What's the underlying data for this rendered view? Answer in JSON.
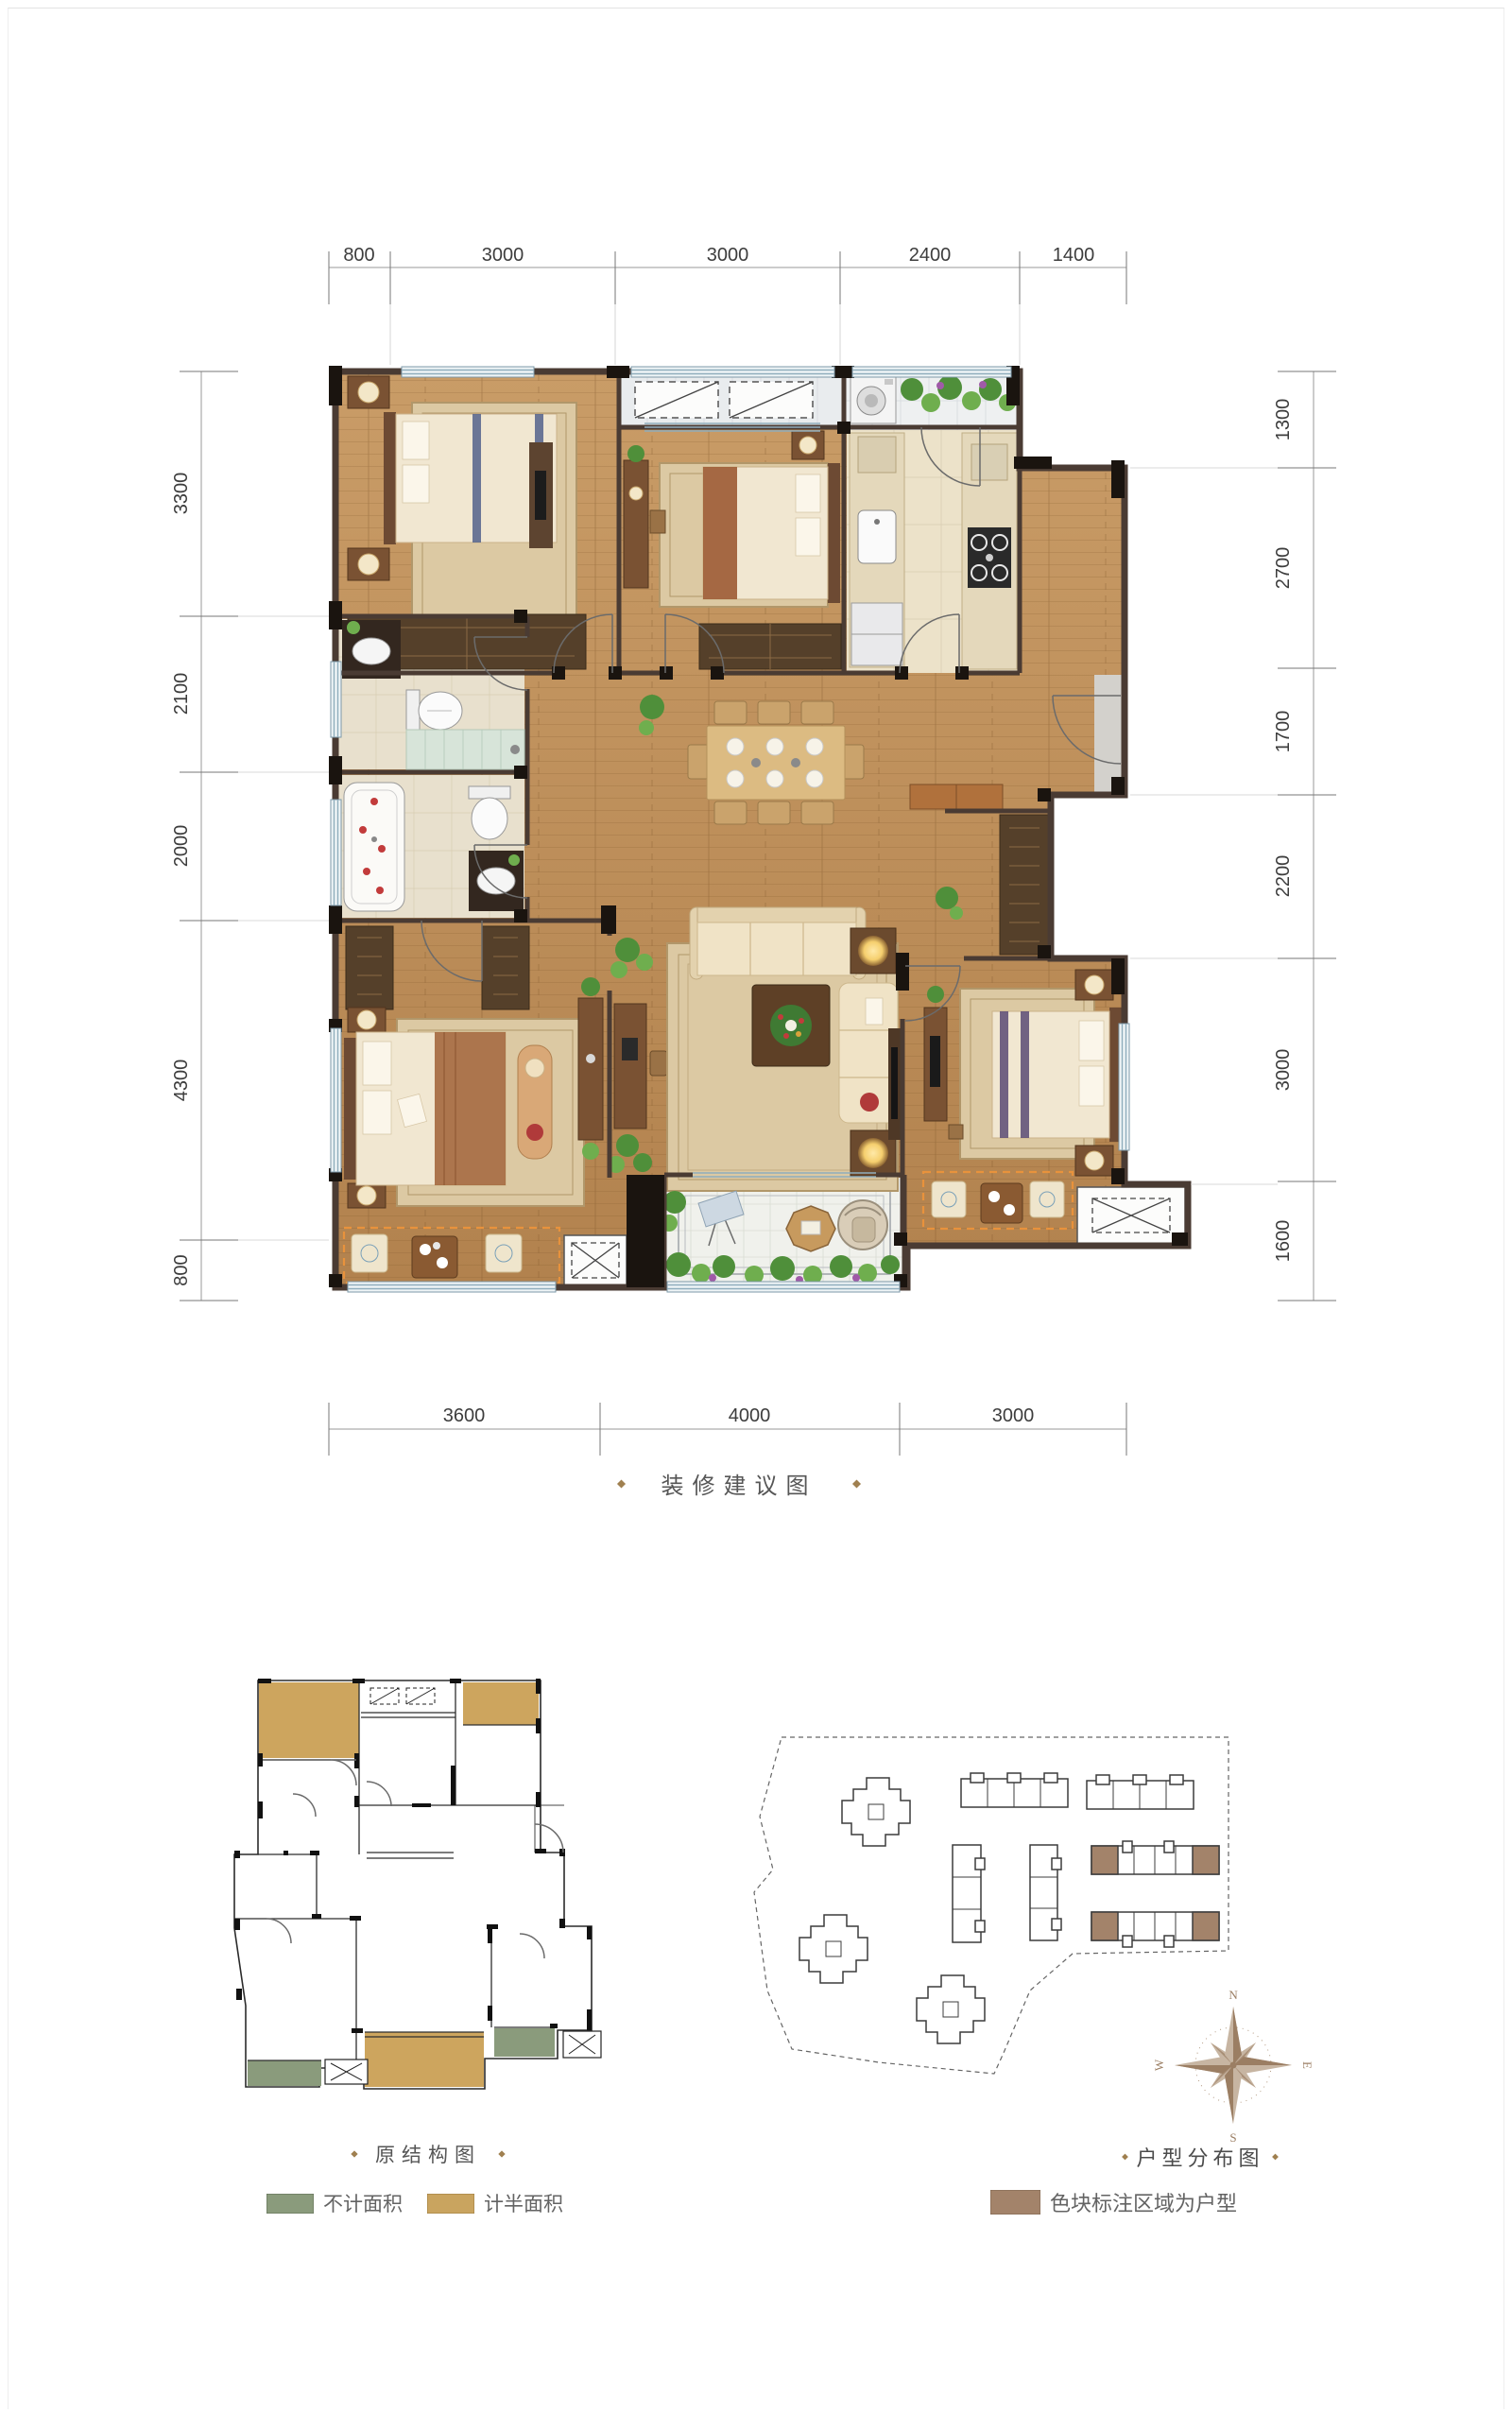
{
  "main_plan": {
    "caption": "装修建议图",
    "dims_top": [
      "800",
      "3000",
      "3000",
      "2400",
      "1400"
    ],
    "dims_left": [
      "3300",
      "2100",
      "2000",
      "4300",
      "800"
    ],
    "dims_right": [
      "1300",
      "2700",
      "1700",
      "2200",
      "3000",
      "1600"
    ],
    "dims_bottom": [
      "3600",
      "4000",
      "3000"
    ]
  },
  "original_plan": {
    "caption": "原结构图",
    "legend": [
      {
        "label": "不计面积",
        "color": "#8a9b7c"
      },
      {
        "label": "计半面积",
        "color": "#c9a45f"
      }
    ]
  },
  "site_plan": {
    "caption": "户型分布图",
    "legend": {
      "label": "色块标注区域为户型",
      "color": "#a3836a"
    },
    "highlight_color": "#a3836a",
    "compass": {
      "n": "N",
      "e": "E",
      "s": "S",
      "w": "W"
    }
  }
}
